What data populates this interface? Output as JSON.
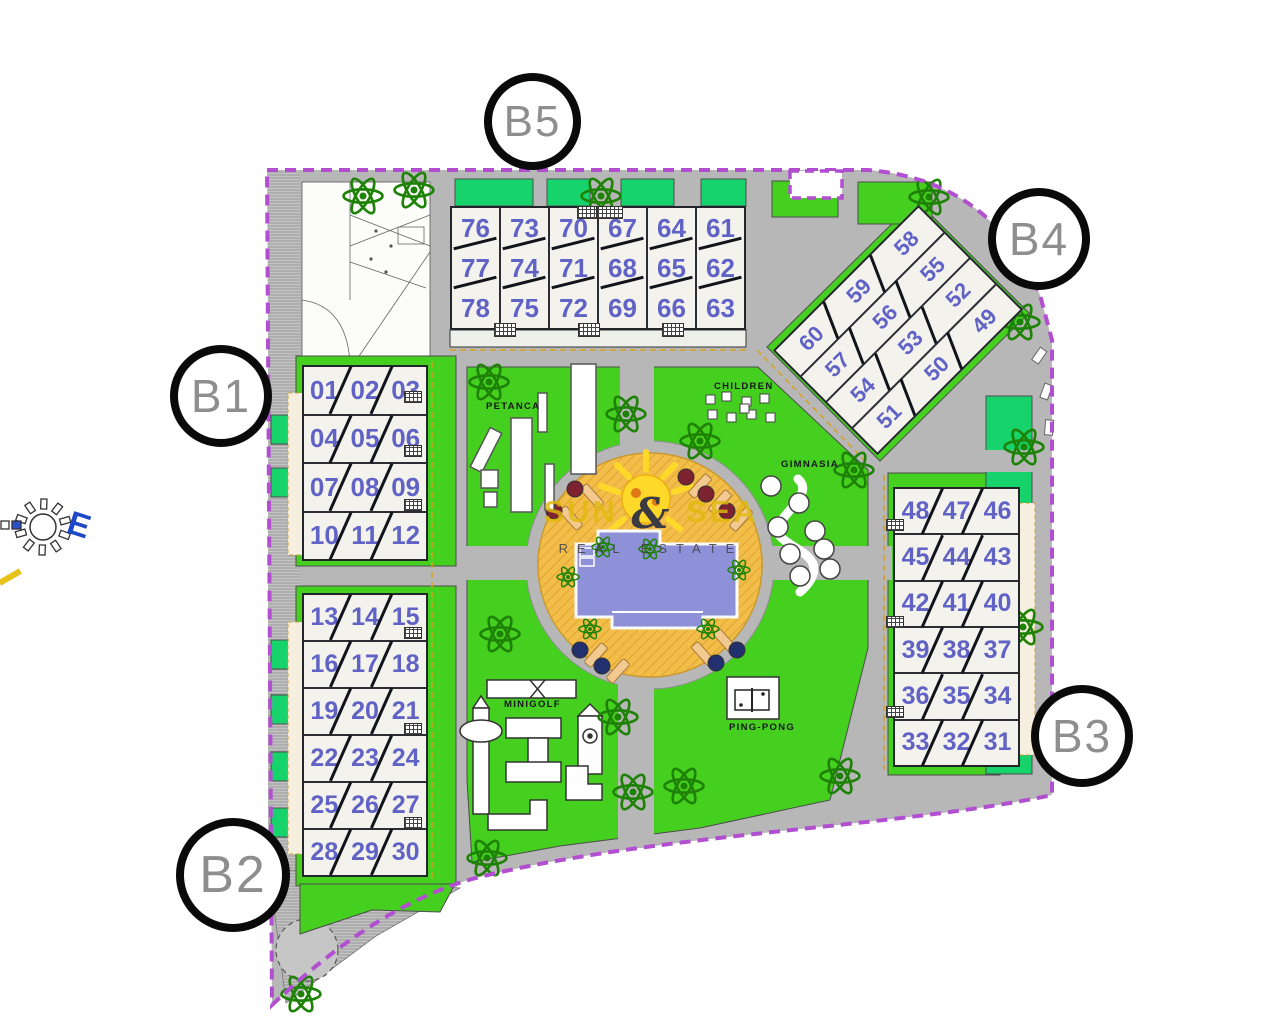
{
  "watermark": {
    "word1": "SUN",
    "ampersand": "&",
    "word2": "SEA",
    "line2": "REAL ESTATE"
  },
  "compass": {
    "east_label": "E"
  },
  "markers": {
    "b1": "B1",
    "b2": "B2",
    "b3": "B3",
    "b4": "B4",
    "b5": "B5"
  },
  "amenities": {
    "petanca": "PETANCA",
    "children": "CHILDREN",
    "gimnasia": "GIMNASIA",
    "minigolf": "MINIGOLF",
    "pingpong": "PING-PONG"
  },
  "buildings": {
    "b5": {
      "columns": [
        [
          "76",
          "77",
          "78"
        ],
        [
          "73",
          "74",
          "75"
        ],
        [
          "70",
          "71",
          "72"
        ],
        [
          "67",
          "68",
          "69"
        ],
        [
          "64",
          "65",
          "66"
        ],
        [
          "61",
          "62",
          "63"
        ]
      ]
    },
    "b4": {
      "rows": [
        [
          "60",
          "59",
          "58"
        ],
        [
          "57",
          "56",
          "55"
        ],
        [
          "54",
          "53",
          "52"
        ],
        [
          "51",
          "50",
          "49"
        ]
      ]
    },
    "b1": {
      "rows": [
        [
          "01",
          "02",
          "03"
        ],
        [
          "04",
          "05",
          "06"
        ],
        [
          "07",
          "08",
          "09"
        ],
        [
          "10",
          "11",
          "12"
        ]
      ]
    },
    "b2": {
      "rows": [
        [
          "13",
          "14",
          "15"
        ],
        [
          "16",
          "17",
          "18"
        ],
        [
          "19",
          "20",
          "21"
        ],
        [
          "22",
          "23",
          "24"
        ],
        [
          "25",
          "26",
          "27"
        ],
        [
          "28",
          "29",
          "30"
        ]
      ]
    },
    "b3": {
      "rows": [
        [
          "48",
          "47",
          "46"
        ],
        [
          "45",
          "44",
          "43"
        ],
        [
          "42",
          "41",
          "40"
        ],
        [
          "39",
          "38",
          "37"
        ],
        [
          "36",
          "35",
          "34"
        ],
        [
          "33",
          "32",
          "31"
        ]
      ]
    }
  },
  "colors": {
    "boundary": "#b14fd0",
    "lawn": "#45d01f",
    "lawn_alt": "#17d36b",
    "road": "#b7b7b7",
    "building_fill": "#f3f2ed",
    "unit_number": "#4c50c0",
    "pool_deck": "#f2bc49",
    "pool_water": "#8e91d8",
    "sun": "#ffd92a",
    "marker_ring": "#0a0a0a",
    "watermark_yellow": "#e0ba0e",
    "compass_east_blue": "#1d49c8"
  }
}
